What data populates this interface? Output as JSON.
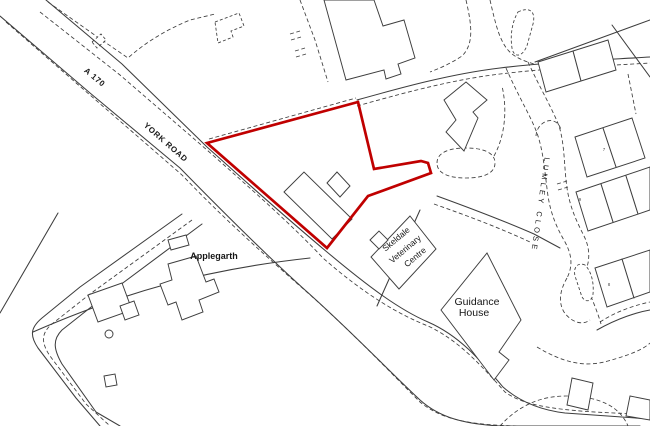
{
  "map": {
    "colors": {
      "background": "#ffffff",
      "linework": "#3d3d3d",
      "boundary": "#c00000"
    },
    "labels": {
      "road_number": "A 170",
      "road_name": "YORK ROAD",
      "street_name": "LUMLEY CLOSE",
      "property_west": "Applegarth",
      "vet_centre_line1": "Skeldale",
      "vet_centre_line2": "Veterinary",
      "vet_centre_line3": "Centre",
      "guidance_line1": "Guidance",
      "guidance_line2": "House",
      "house_numbers": [
        "7",
        "9",
        "8"
      ]
    }
  }
}
